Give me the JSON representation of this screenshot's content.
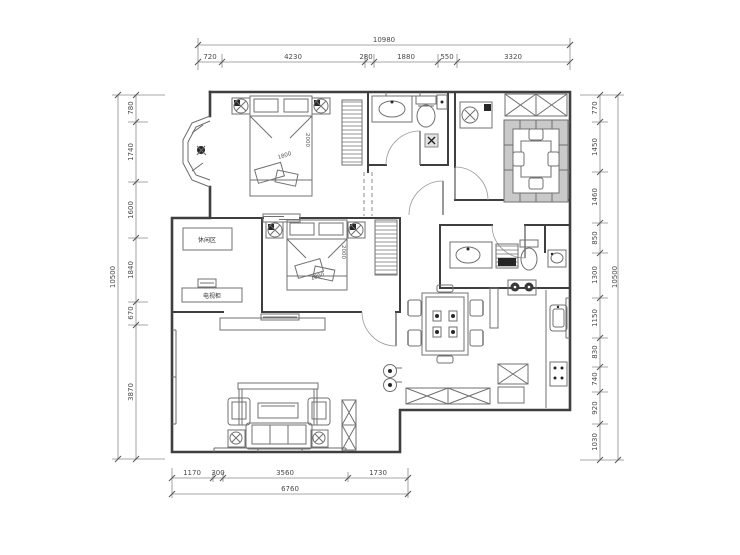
{
  "drawing": {
    "type": "apartment-floor-plan",
    "units": "mm",
    "background": "#ffffff",
    "colors": {
      "walls": "#3f3f3f",
      "furniture": "#707070",
      "dimensions": "#555555"
    }
  },
  "dims": {
    "top": {
      "overall": "10980",
      "segments": [
        "720",
        "4230",
        "280",
        "1880",
        "550",
        "3320"
      ]
    },
    "left": {
      "overall": "10500",
      "segments": [
        "780",
        "1740",
        "1600",
        "1840",
        "670",
        "3870"
      ]
    },
    "right": {
      "overall": "10500",
      "segments": [
        "770",
        "1450",
        "1460",
        "850",
        "1300",
        "1150",
        "830",
        "740",
        "920",
        "1030"
      ]
    },
    "bottom": {
      "overall": "6760",
      "segments": [
        "1170",
        "300",
        "3560",
        "1730"
      ]
    }
  },
  "labels": {
    "bed1_length": "2000",
    "bed1_width": "1800",
    "bed2_length": "2000",
    "bed2_width": "1800",
    "leisure_area": "休闲区",
    "tv_cabinet": "电视柜"
  }
}
